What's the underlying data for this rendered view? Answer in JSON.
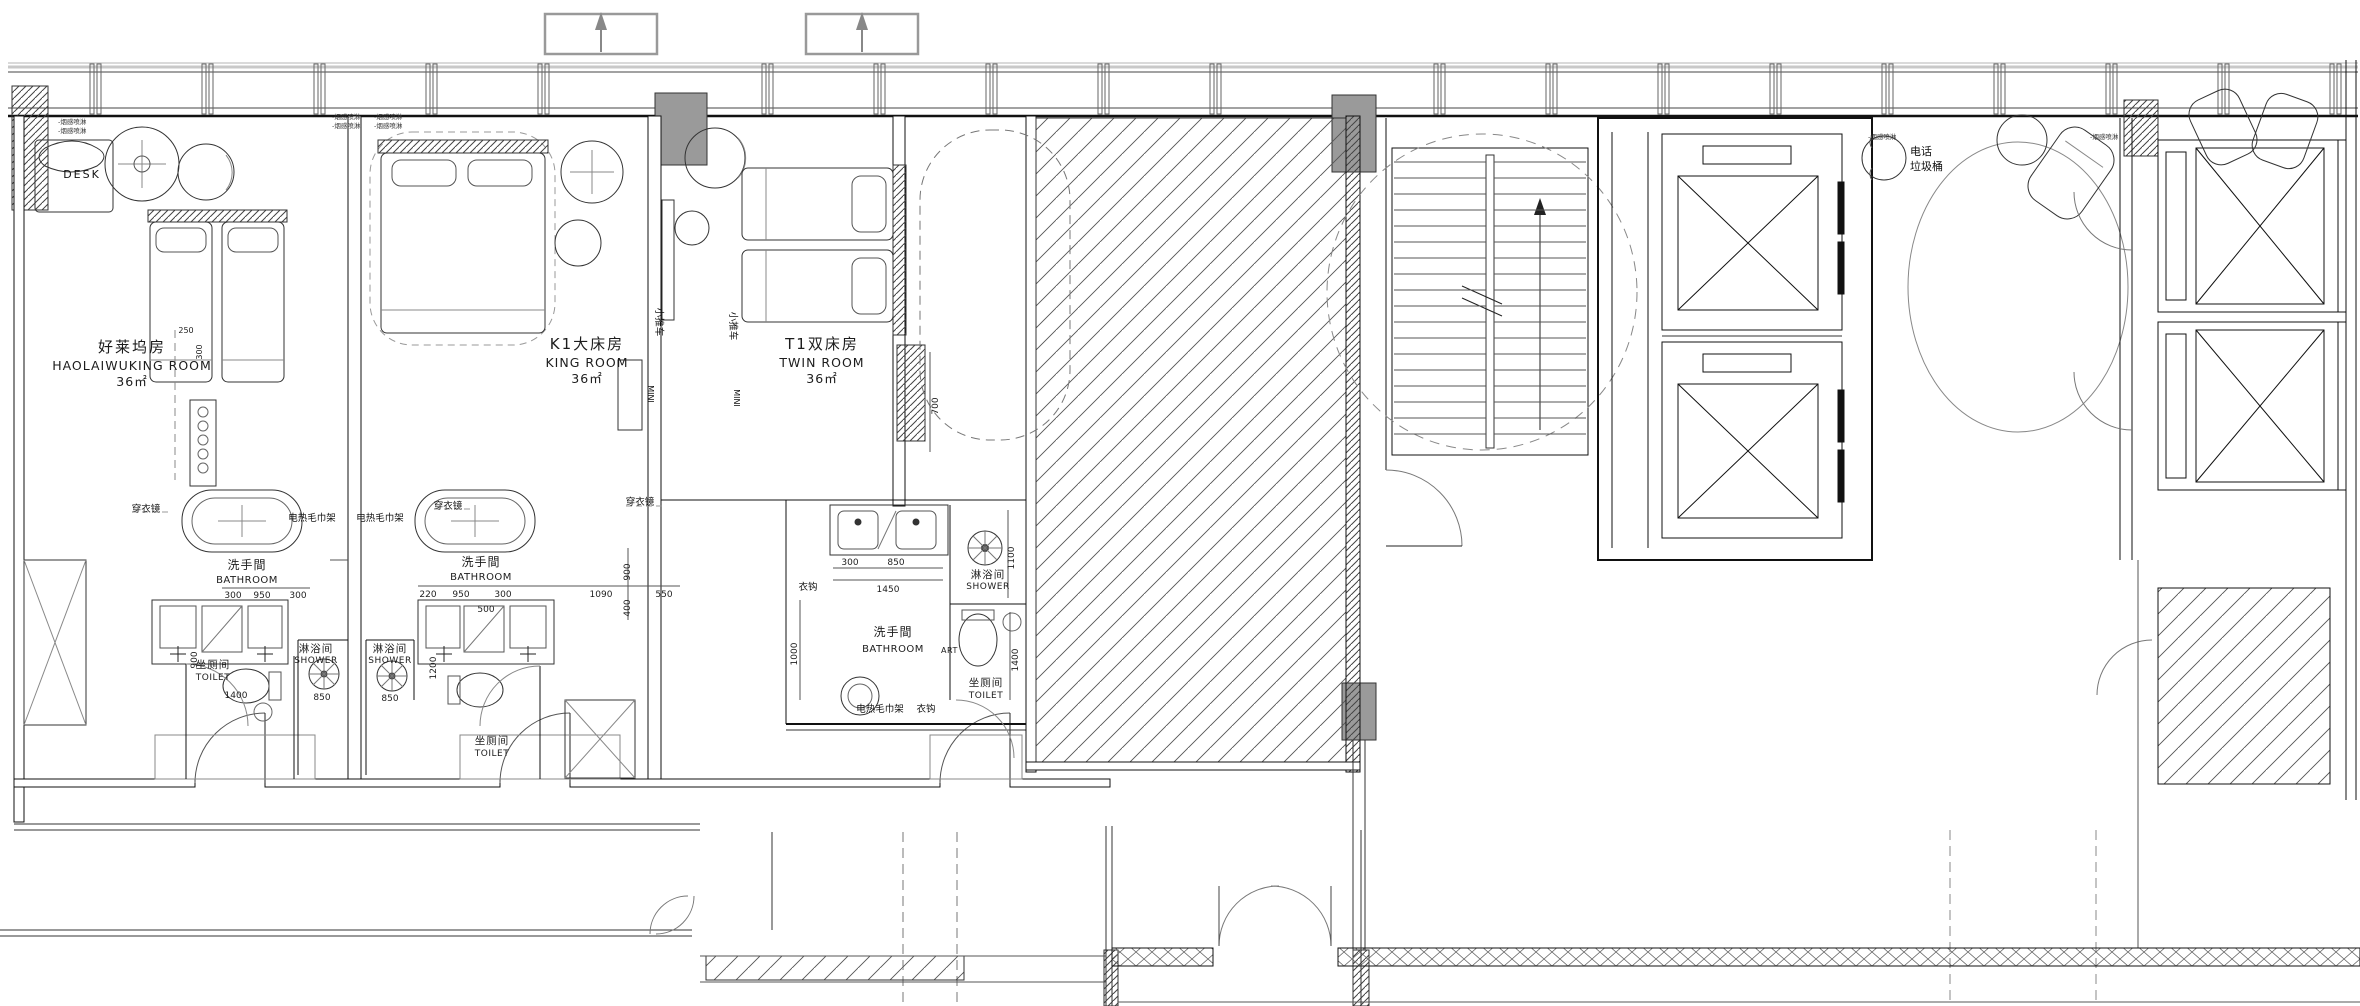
{
  "drawing": {
    "rooms": [
      {
        "name_cn": "好莱坞房",
        "name_en": "HAOLAIWUKING ROOM",
        "area": "36㎡"
      },
      {
        "name_cn": "K1大床房",
        "name_en": "KING ROOM",
        "area": "36㎡"
      },
      {
        "name_cn": "T1双床房",
        "name_en": "TWIN ROOM",
        "area": "36㎡"
      }
    ],
    "spaces": {
      "bathroom_cn": "洗手間",
      "bathroom_en": "BATHROOM",
      "bathroom_suffix": "ART",
      "shower_cn": "淋浴间",
      "shower_en": "SHOWER",
      "toilet_cn": "坐厕间",
      "toilet_en": "TOILET"
    },
    "annotations": {
      "desk": "DESK",
      "mirror": "穿衣镜",
      "towel_rack": "电热毛巾架",
      "hook": "衣钩",
      "phone": "电话",
      "trash": "垃圾桶",
      "cart": "小推车",
      "minibar": "MINI",
      "sprinkler": "-烟感喷淋"
    },
    "dimensions": {
      "bath1": [
        "300",
        "950",
        "300",
        "1400",
        "850",
        "900"
      ],
      "bath2": [
        "220",
        "950",
        "300",
        "1090",
        "550",
        "500",
        "900",
        "400",
        "1200",
        "850"
      ],
      "bath3": [
        "300",
        "850",
        "1450",
        "1000",
        "1100",
        "1400",
        "700"
      ],
      "wardrobe": [
        "250",
        "300"
      ]
    }
  }
}
